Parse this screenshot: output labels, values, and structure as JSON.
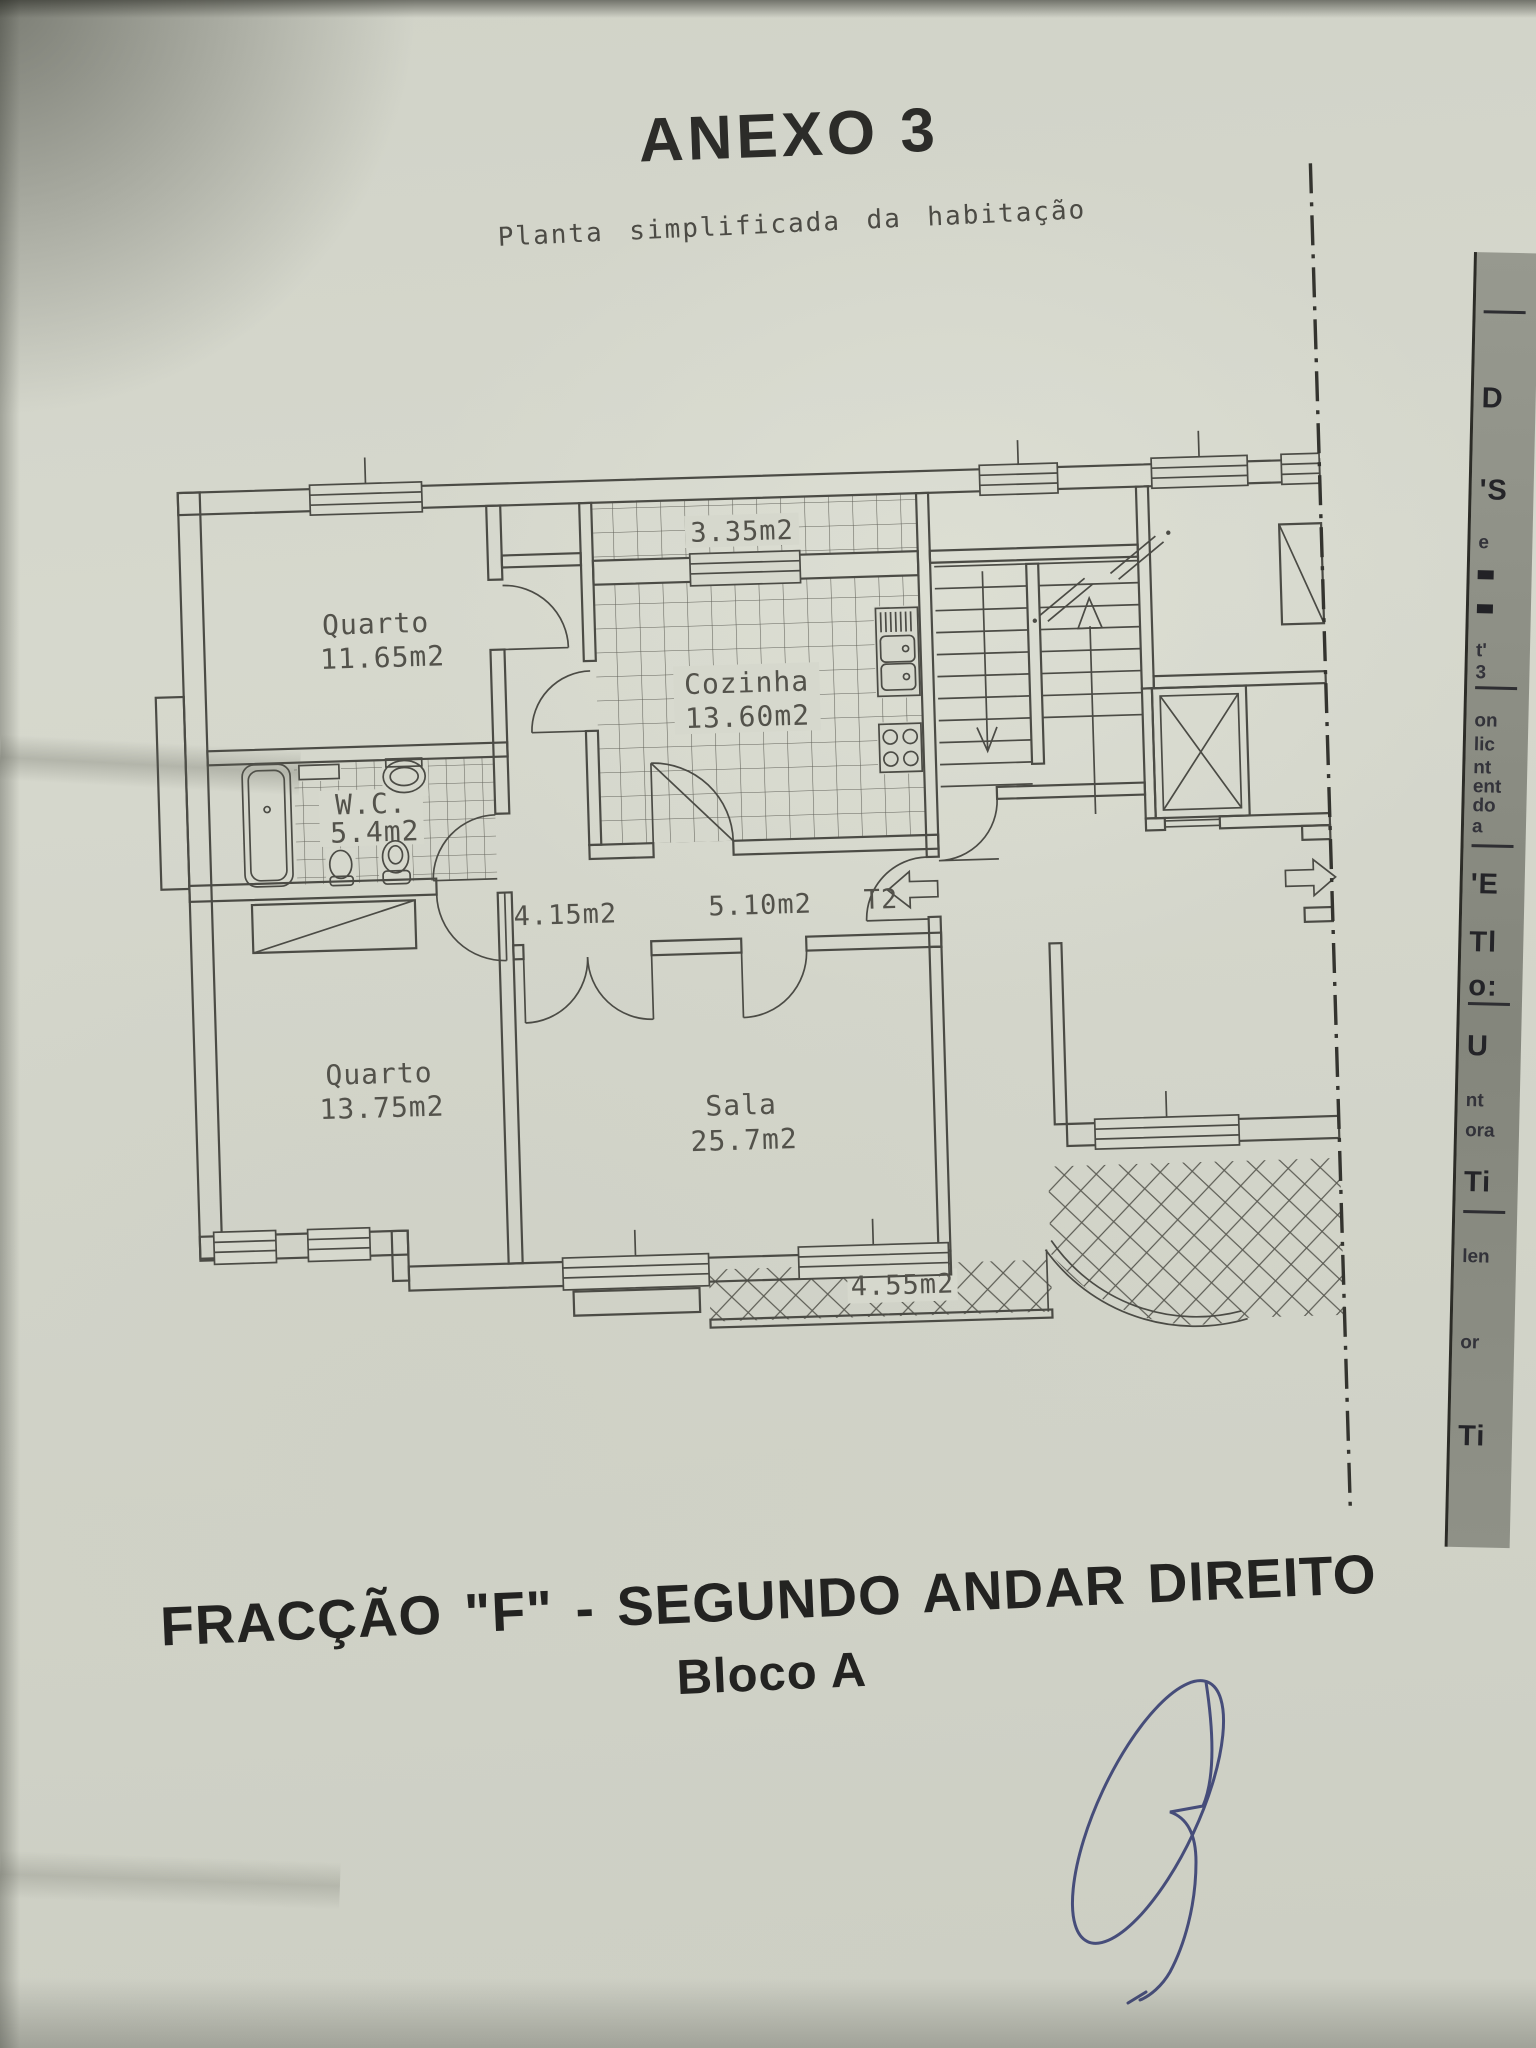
{
  "page": {
    "title": "ANEXO 3",
    "subtitle": "Planta simplificada da habitação",
    "caption_line1": "FRACÇÃO \"F\" - SEGUNDO ANDAR DIREITO",
    "caption_line2": "Bloco A"
  },
  "plan": {
    "unit_type_label": "T2",
    "rooms": [
      {
        "name": "Quarto",
        "area": "11.65m2"
      },
      {
        "name": "Cozinha",
        "area": "13.60m2"
      },
      {
        "name": "W.C.",
        "area": "5.4m2"
      },
      {
        "name": "Quarto",
        "area": "13.75m2"
      },
      {
        "name": "Sala",
        "area": "25.7m2"
      }
    ],
    "areas": {
      "terrace": "3.35m2",
      "hall": "4.15m2",
      "corridor": "5.10m2",
      "balcony": "4.55m2"
    }
  },
  "underlay_fragments": [
    {
      "text": "",
      "y": 58,
      "style": "line"
    },
    {
      "text": "D",
      "y": 130,
      "style": "big"
    },
    {
      "text": "'S",
      "y": 222,
      "style": "big"
    },
    {
      "text": "e",
      "y": 280,
      "style": "small"
    },
    {
      "text": "",
      "y": 318,
      "style": "block"
    },
    {
      "text": "",
      "y": 352,
      "style": "block"
    },
    {
      "text": "t'",
      "y": 388,
      "style": "small"
    },
    {
      "text": "3",
      "y": 410,
      "style": "small"
    },
    {
      "text": "",
      "y": 434,
      "style": "line"
    },
    {
      "text": "on",
      "y": 458,
      "style": "small"
    },
    {
      "text": "lic",
      "y": 482,
      "style": "small"
    },
    {
      "text": "nt",
      "y": 505,
      "style": "small"
    },
    {
      "text": "ent",
      "y": 524,
      "style": "small"
    },
    {
      "text": "do",
      "y": 543,
      "style": "small"
    },
    {
      "text": "a",
      "y": 564,
      "style": "small"
    },
    {
      "text": "",
      "y": 592,
      "style": "line"
    },
    {
      "text": "'E",
      "y": 616,
      "style": "big"
    },
    {
      "text": "Tl",
      "y": 674,
      "style": "big"
    },
    {
      "text": "o:",
      "y": 718,
      "style": "big"
    },
    {
      "text": "",
      "y": 750,
      "style": "line"
    },
    {
      "text": "U",
      "y": 778,
      "style": "big"
    },
    {
      "text": "nt",
      "y": 838,
      "style": "small"
    },
    {
      "text": "ora",
      "y": 868,
      "style": "small"
    },
    {
      "text": "Ti",
      "y": 914,
      "style": "big"
    },
    {
      "text": "",
      "y": 958,
      "style": "line"
    },
    {
      "text": "len",
      "y": 994,
      "style": "small"
    },
    {
      "text": "or",
      "y": 1080,
      "style": "small"
    },
    {
      "text": "Ti",
      "y": 1168,
      "style": "big"
    }
  ]
}
